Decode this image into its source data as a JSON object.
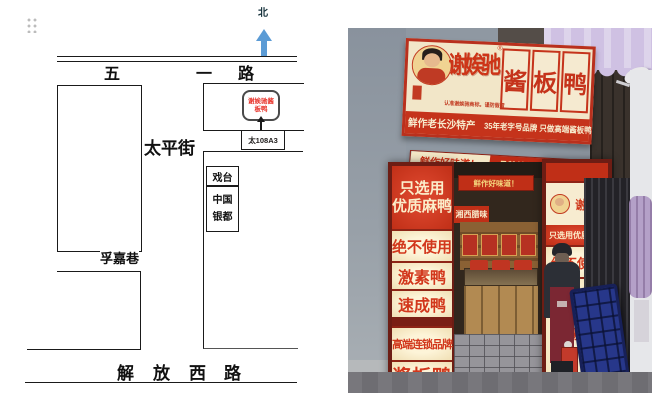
{
  "map": {
    "north": "北",
    "wuyi": {
      "c0": "五",
      "c1": "一",
      "c2": "路"
    },
    "taiping": "太平街",
    "fujia": "孚嘉巷",
    "jiefang": {
      "c0": "解",
      "c1": "放",
      "c2": "西",
      "c3": "路"
    },
    "stage": "戏台",
    "yindu_line1": "中国",
    "yindu_line2": "银都",
    "callout_line1": "谢娭驰酱",
    "callout_line2": "板鸭",
    "plate": "太108A3",
    "colors": {
      "arrow_blue": "#5b9bd5",
      "callout_red": "#e8332a",
      "line_black": "#1a1a1a"
    }
  },
  "photo": {
    "sign": {
      "brand": "谢娭驰",
      "reg": "®",
      "tile0": "酱",
      "tile1": "板",
      "tile2": "鸭",
      "disclaimer": "认准谢娭驰商标。谨防假冒",
      "strip_left": "鲜作老长沙特产",
      "strip_right": "35年老字号品牌 只做高端酱板鸭"
    },
    "banner_left": "鲜作好味道！",
    "banner_right": "品牌始创于1988年",
    "left_pillar": {
      "a_line1": "只选用",
      "a_line2": "优质麻鸭",
      "b": "绝不使用",
      "c": "激素鸭",
      "d": "速成鸭",
      "e": "高端连锁品牌",
      "f": "酱板鸭"
    },
    "right_pillar": {
      "brand": "谢娭驰",
      "l1": "只选用优质麻鸭",
      "l2": "绝不使用",
      "l3": "激素鸭"
    },
    "inner_banner": "鲜作好味道！",
    "side_sign": "湘西腊味",
    "colors": {
      "sign_red": "#c5331b",
      "cream": "#f2e6c8",
      "awning": "#cfc1e3"
    }
  }
}
